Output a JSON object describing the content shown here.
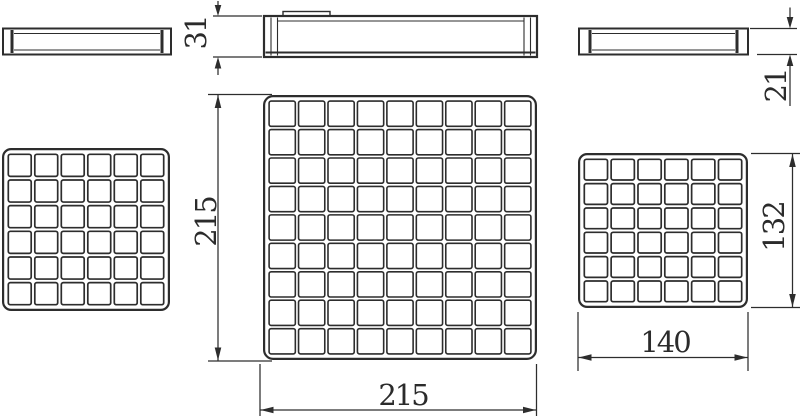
{
  "meta": {
    "drawing_type": "technical drawing - drain grate views",
    "line_color": "#2d2d2d",
    "background": "#ffffff"
  },
  "grids": {
    "left": {
      "x": 2,
      "y": 148,
      "w": 168,
      "h": 163,
      "rows": 6,
      "cols": 6,
      "inset": 4.5,
      "gap": 3.6,
      "corner_radius": 8,
      "cell_radius": 2,
      "cell_stroke": 1.7,
      "outer_stroke": 2.2
    },
    "center": {
      "x": 263,
      "y": 95,
      "w": 274,
      "h": 265,
      "rows": 9,
      "cols": 9,
      "inset": 4.5,
      "gap": 3.2,
      "corner_radius": 9,
      "cell_radius": 2,
      "cell_stroke": 1.6,
      "outer_stroke": 2.2
    },
    "right": {
      "x": 578,
      "y": 153,
      "w": 170,
      "h": 155,
      "rows": 6,
      "cols": 6,
      "inset": 4.5,
      "gap": 3.6,
      "corner_radius": 8,
      "cell_radius": 2,
      "cell_stroke": 1.7,
      "outer_stroke": 2.2
    }
  },
  "dimensions": {
    "center_side_height": "31",
    "right_side_height": "21",
    "center_grid_height": "215",
    "center_grid_width": "215",
    "right_grid_height": "132",
    "right_grid_width": "140"
  }
}
